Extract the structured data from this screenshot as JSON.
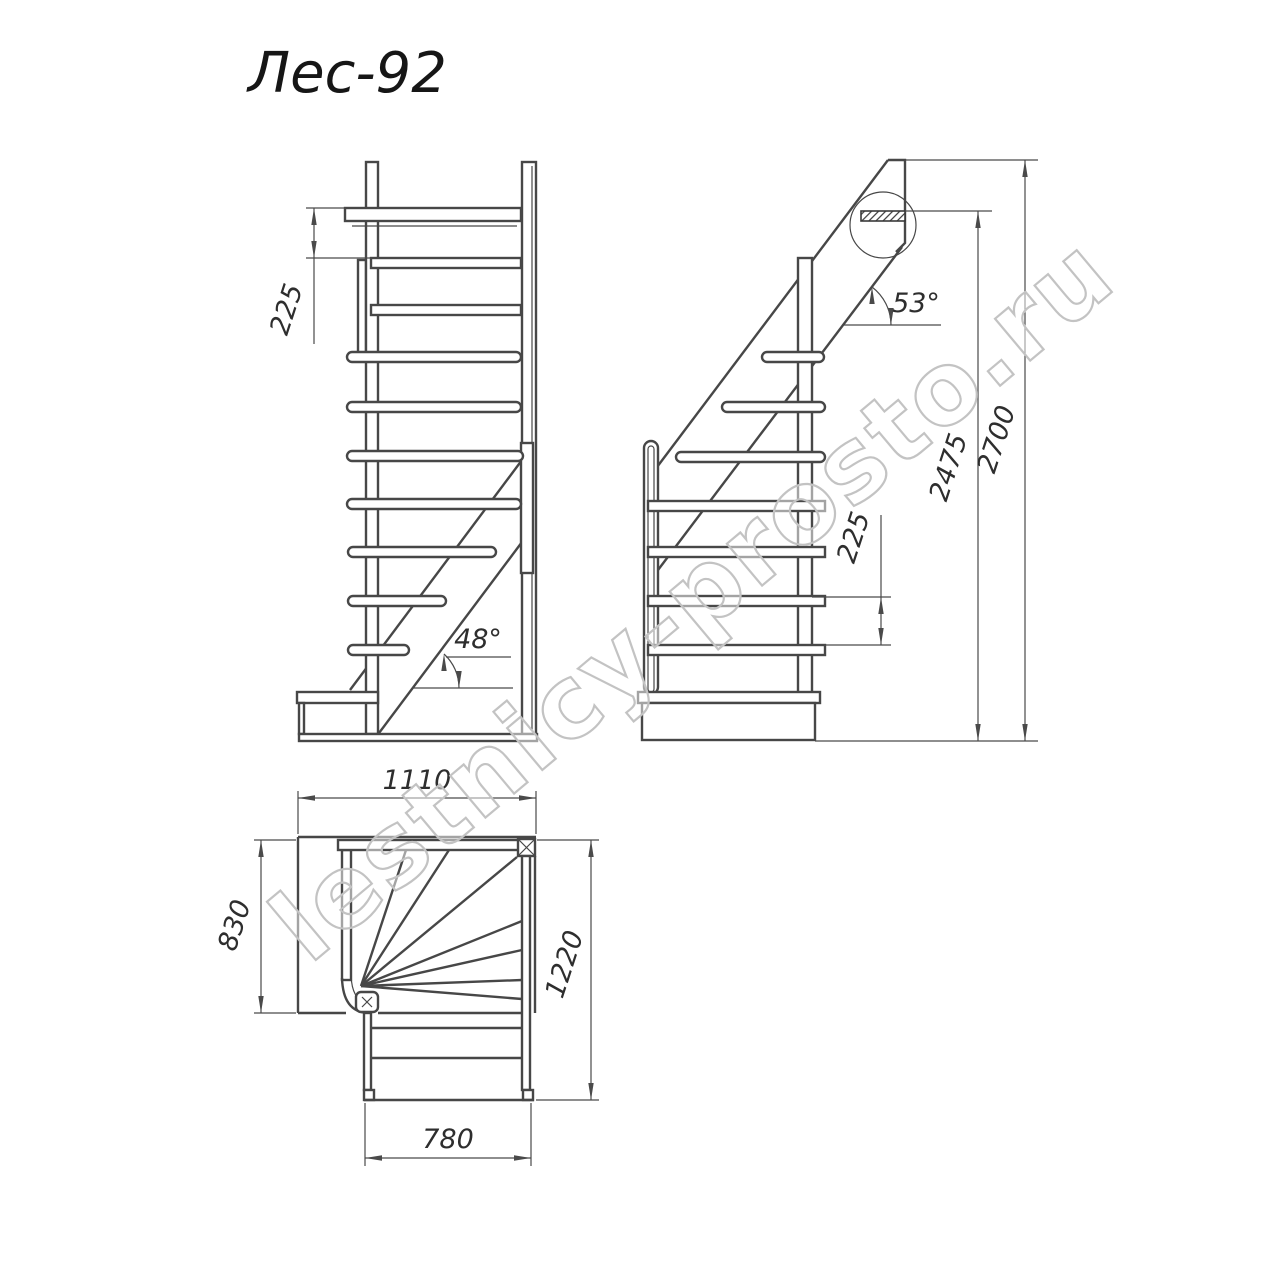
{
  "title": "Лес-92",
  "watermark": "lestnicy-prosto.ru",
  "colors": {
    "line": "#474747",
    "dim": "#4a4a4a",
    "text": "#2e2e2e",
    "watermark": "#c3c3c3",
    "background": "#ffffff"
  },
  "views": {
    "front": {
      "riser_height": "225",
      "stringer_angle": "48°"
    },
    "side": {
      "stringer_angle": "53°",
      "riser_height": "225",
      "upper_floor_height": "2475",
      "total_height": "2700"
    },
    "plan": {
      "top_width": "1110",
      "landing_depth": "830",
      "total_depth": "1220",
      "flight_width": "780"
    }
  }
}
